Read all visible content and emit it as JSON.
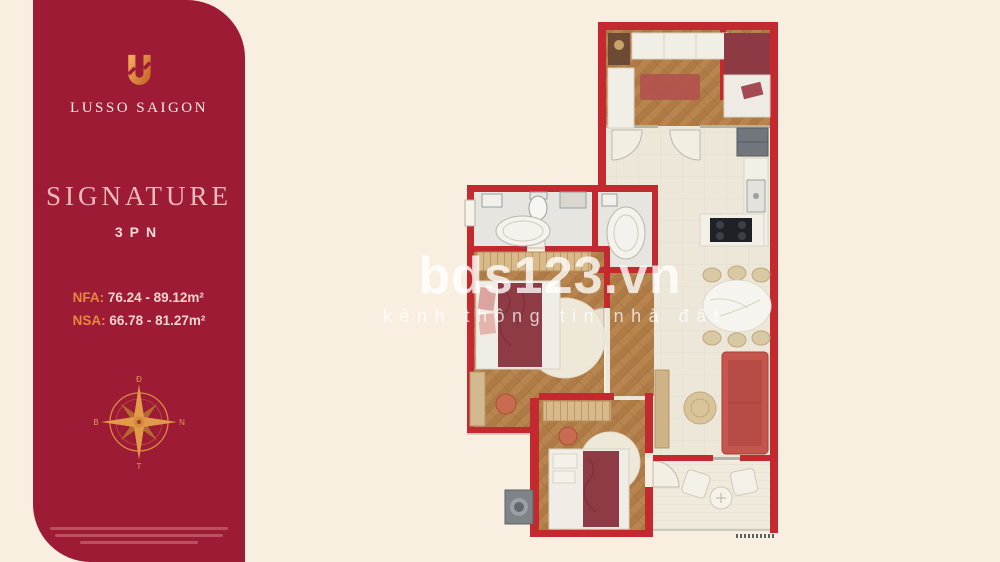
{
  "colors": {
    "background": "#f8efe1",
    "panel_red": "#9e1b36",
    "wall_red": "#c3292e",
    "accent_gold": "#dd8a3f",
    "title_pink": "#ecb9bd",
    "blanket_red": "#8e3b45",
    "sofa_red": "#c4564e",
    "wood_floor": "#b8854f"
  },
  "panel": {
    "brand": "LUSSO SAIGON",
    "title": "SIGNATURE",
    "subtitle": "3PN",
    "metrics": {
      "nfa_label": "NFA:",
      "nfa_value": "76.24 - 89.12m²",
      "nsa_label": "NSA:",
      "nsa_value": "66.78 - 81.27m²"
    },
    "compass": {
      "top": "Đ",
      "right": "N",
      "bottom": "T",
      "left": "B"
    }
  },
  "watermark": {
    "brand": "bds123.vn",
    "tagline": "kênh thông tin nhà đất"
  },
  "floor_plan": {
    "type": "apartment-floor-plan-3-bedroom"
  }
}
